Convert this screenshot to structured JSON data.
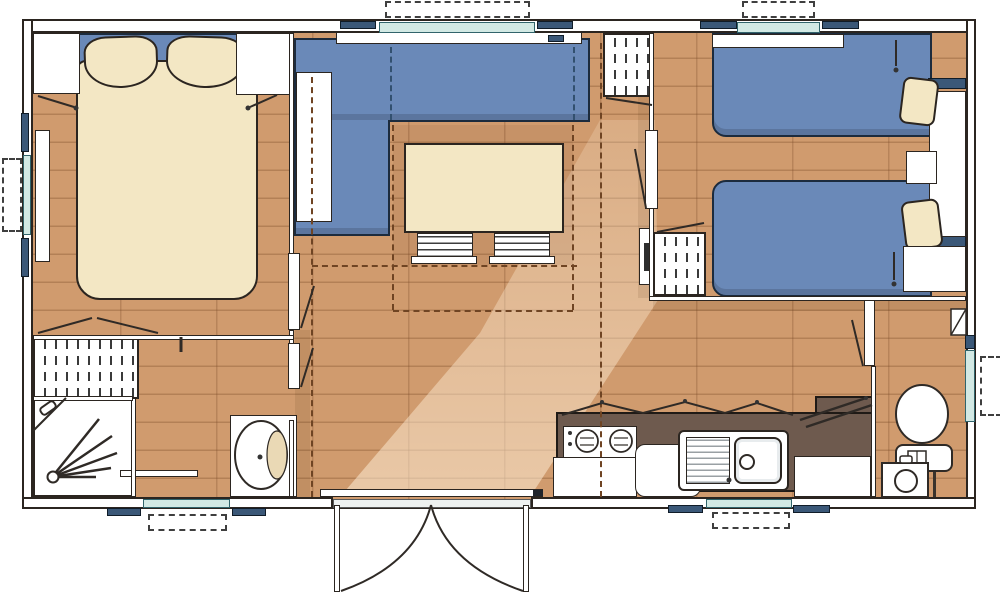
{
  "plan_type": "mobile-home-floor-plan",
  "colors": {
    "floor": "#d09b6e",
    "floor_line": "#a97646",
    "wall_fill": "#ffffff",
    "outline": "#2b2520",
    "blue": "#6a89b8",
    "blue_dark": "#32506f",
    "cream": "#f3e7c4",
    "counter": "#6e5a4e",
    "glass": "#d2e9e4",
    "navy": "#3b5878",
    "dash_brown": "#6f4423",
    "light": "#ffeed6"
  },
  "rooms": {
    "master_bedroom": {
      "items": [
        "double-bed",
        "pillow-left",
        "pillow-right",
        "nightstand-left",
        "nightstand-right",
        "wall-lamp-left",
        "wall-lamp-right",
        "window-left",
        "shelf",
        "wardrobe"
      ]
    },
    "living_area": {
      "items": [
        "corner-sofa",
        "drop-down-bunk",
        "window-shelf",
        "dining-table",
        "chair-1",
        "chair-2",
        "wardrobe",
        "heater-panel",
        "window-top"
      ]
    },
    "twin_bedroom": {
      "items": [
        "single-bed-1",
        "single-bed-2",
        "pillow-1",
        "pillow-2",
        "head-shelf-1",
        "head-shelf-2",
        "nightstand",
        "wardrobe-tall",
        "wardrobe-low",
        "reading-lamp-1",
        "reading-lamp-2",
        "window-top",
        "door"
      ]
    },
    "shower_room": {
      "items": [
        "shower-tray",
        "shower-head",
        "wardrobe",
        "washbasin",
        "folding-door",
        "window-bottom"
      ]
    },
    "wc": {
      "items": [
        "toilet",
        "corner-basin",
        "vent",
        "window-right",
        "door"
      ]
    },
    "kitchen": {
      "items": [
        "hob-2-burners",
        "sink-with-drainer",
        "base-cabinet",
        "fridge",
        "cabinet-right",
        "wall-cabinets",
        "window-bottom"
      ]
    },
    "entrance": {
      "items": [
        "double-french-door",
        "threshold",
        "step-bar"
      ]
    }
  },
  "window_count": 6,
  "door_count": 6
}
